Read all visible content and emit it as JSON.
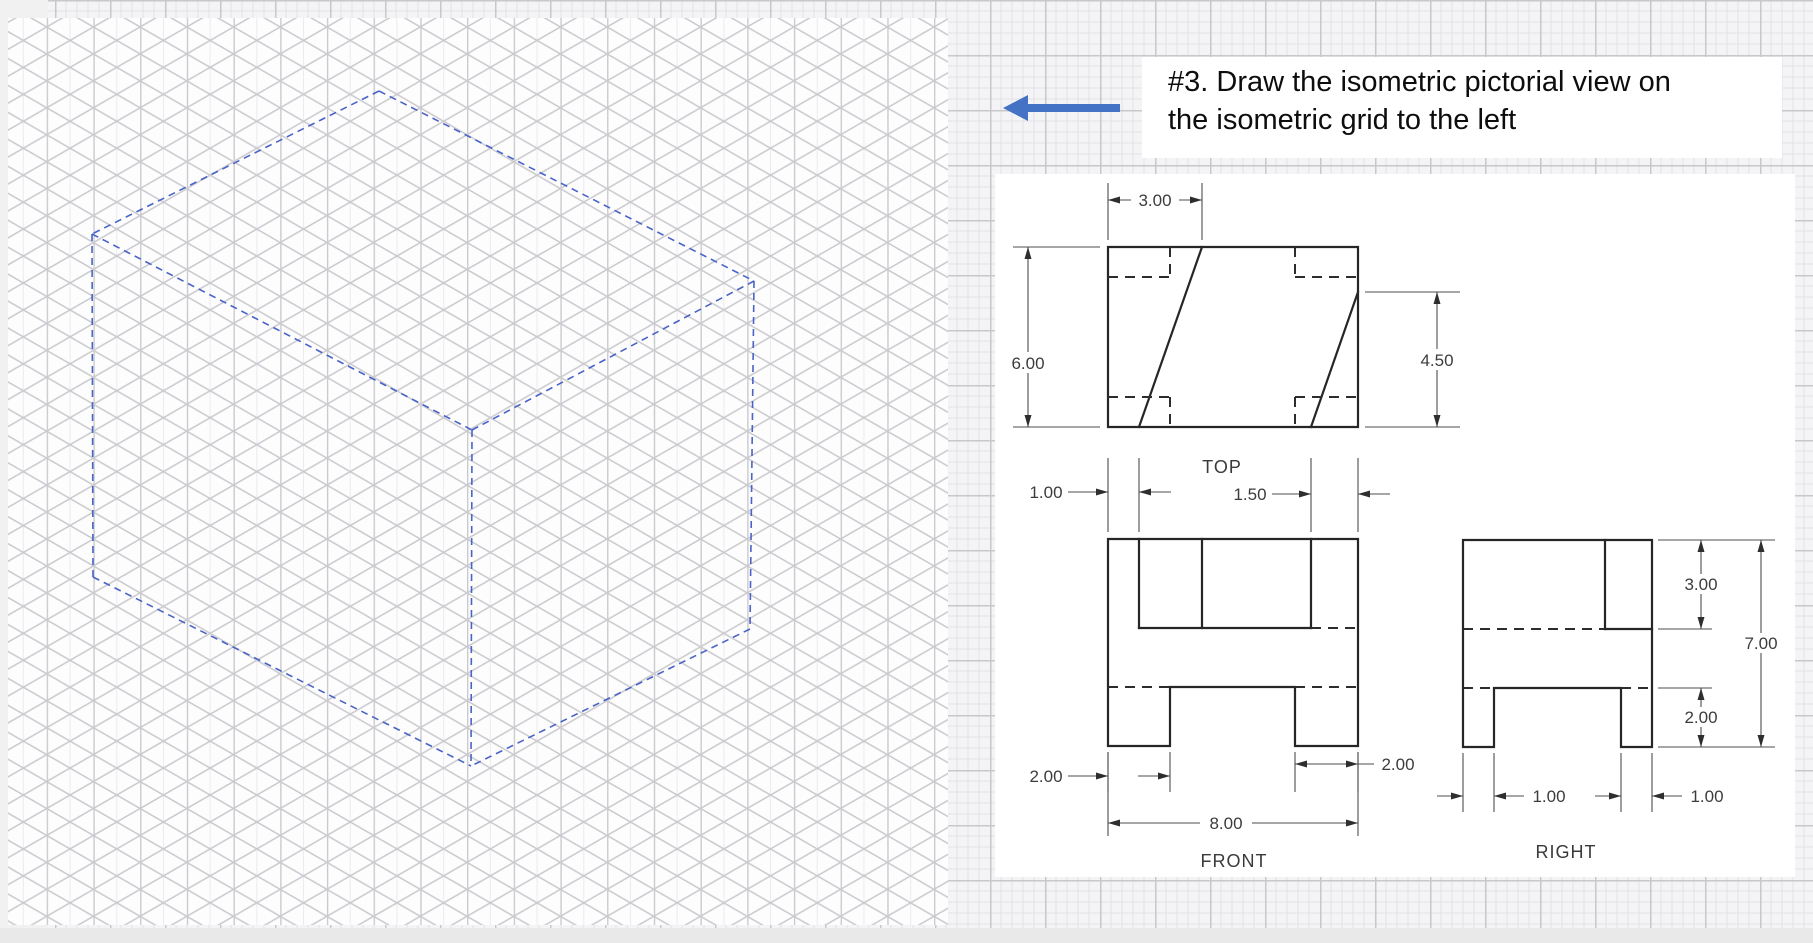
{
  "instruction": {
    "line1": "#3.  Draw the isometric pictorial view on",
    "line2": "the isometric grid to the left"
  },
  "views": {
    "top": {
      "label": "TOP",
      "dim_top_width": "3.00",
      "dim_left_depth": "6.00",
      "dim_right_depth": "4.50"
    },
    "front": {
      "label": "FRONT",
      "dim_top_left": "1.00",
      "dim_top_right": "1.50",
      "dim_bottom_left": "2.00",
      "dim_bottom_right": "2.00",
      "dim_total_width": "8.00"
    },
    "right": {
      "label": "RIGHT",
      "dim_upper_height": "3.00",
      "dim_total_height": "7.00",
      "dim_lower_height": "2.00",
      "dim_leg_front": "1.00",
      "dim_leg_back": "1.00"
    }
  },
  "icons": {
    "left_arrow": "left-arrow-icon"
  },
  "colors": {
    "accent_blue_arrow": "#4472C4",
    "iso_outline_blue": "#4A63C8",
    "object_line": "#262626",
    "grid_line": "#C9C9CE",
    "graph_major": "#C7C7CC",
    "graph_minor": "#E2E2E6",
    "sheet_white": "#FDFDFD"
  }
}
